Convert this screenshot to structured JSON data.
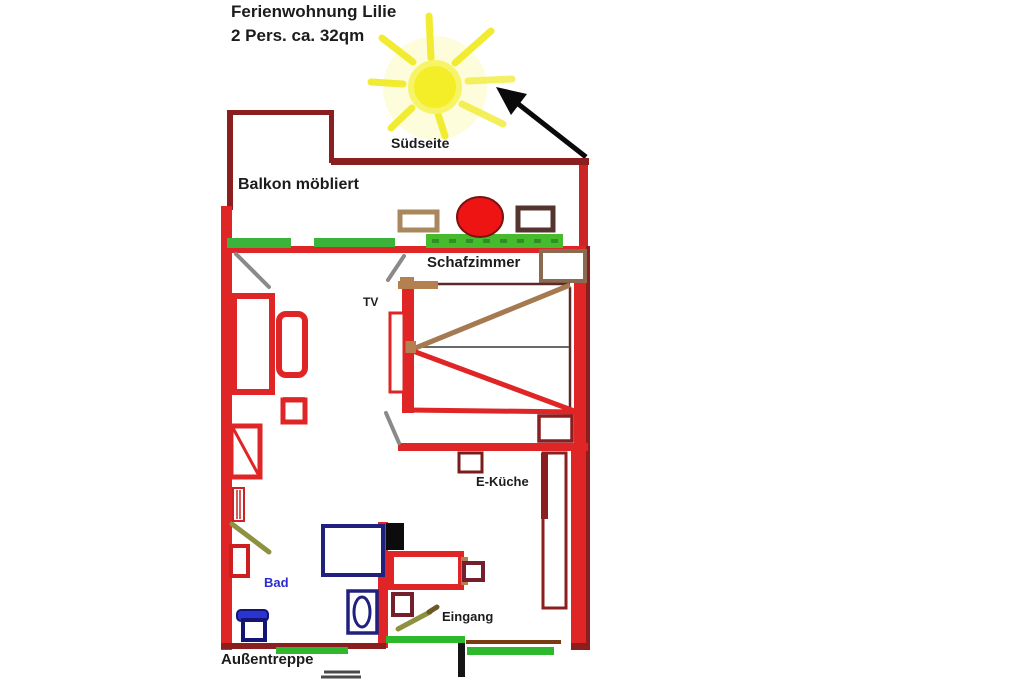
{
  "title": {
    "line1": "Ferienwohnung Lilie",
    "line2": "2 Pers. ca. 32qm"
  },
  "labels": {
    "south_side": "Südseite",
    "balcony": "Balkon möbliert",
    "bedroom": "Schafzimmer",
    "tv": "TV",
    "kitchen": "E-Küche",
    "bath": "Bad",
    "entrance": "Eingang",
    "outdoor_stairs": "Außentreppe"
  },
  "icons": {
    "sun": "sun-icon",
    "direction_arrow": "direction-arrow-icon",
    "stairs_marks": "stairs-icon"
  },
  "colors": {
    "wall_bright_red": "#df2525",
    "wall_dark_red": "#8b1f1f",
    "plant_green": "#3cb43c",
    "grass_green": "#46bb2e",
    "mat_green": "#2eb82e",
    "door_olive": "#8e9140",
    "door_gray": "#8a8a8a",
    "furniture_tan": "#b5804f",
    "closet_brown": "#8a6a50",
    "bath_fixture_blue": "#20207e",
    "toilet_blue": "#2a35cf",
    "bath_label_blue": "#2b2bd0",
    "sun_yellow": "#f3ee28",
    "round_table_red": "#ee1414",
    "arrow_black": "#0a0a0a"
  }
}
